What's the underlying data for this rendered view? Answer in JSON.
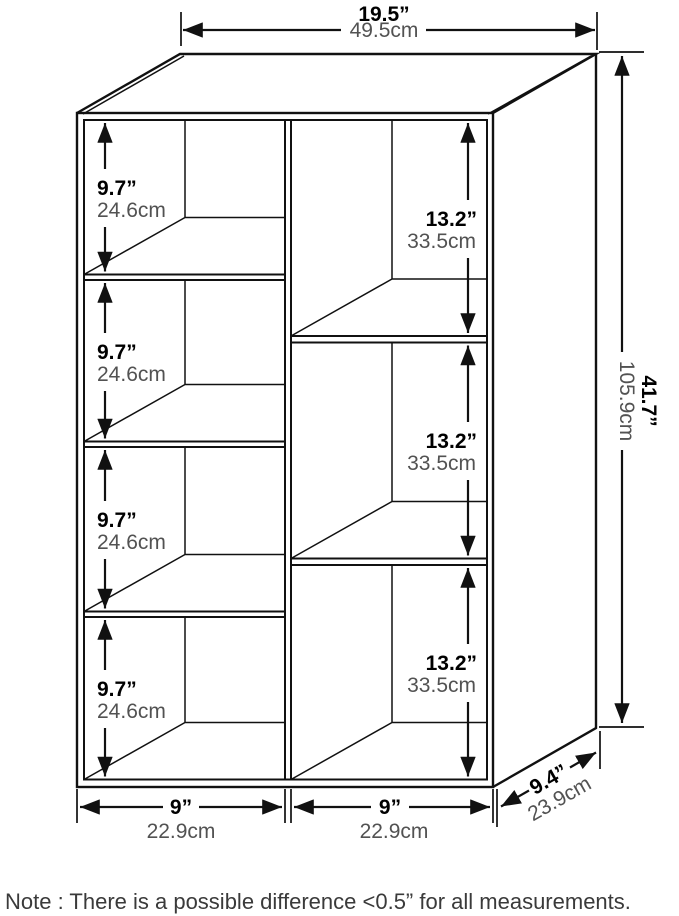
{
  "product": "7-cube open bookcase dimension diagram",
  "dimensions": {
    "width": {
      "in": "19.5”",
      "cm": "49.5cm"
    },
    "height": {
      "in": "41.7”",
      "cm": "105.9cm"
    },
    "depth": {
      "in": "9.4”",
      "cm": "23.9cm"
    },
    "cube_left": {
      "in": "9.7”",
      "cm": "24.6cm"
    },
    "cube_right": {
      "in": "13.2”",
      "cm": "33.5cm"
    },
    "column": {
      "in": "9”",
      "cm": "22.9cm"
    }
  },
  "structure": {
    "left_compartments": 4,
    "right_compartments": 3
  },
  "note": {
    "text": "Note : There is a possible difference <0.5” for all measurements."
  },
  "colors": {
    "line": "#111111",
    "text_primary": "#000000",
    "text_secondary": "#525252",
    "background": "#ffffff"
  }
}
